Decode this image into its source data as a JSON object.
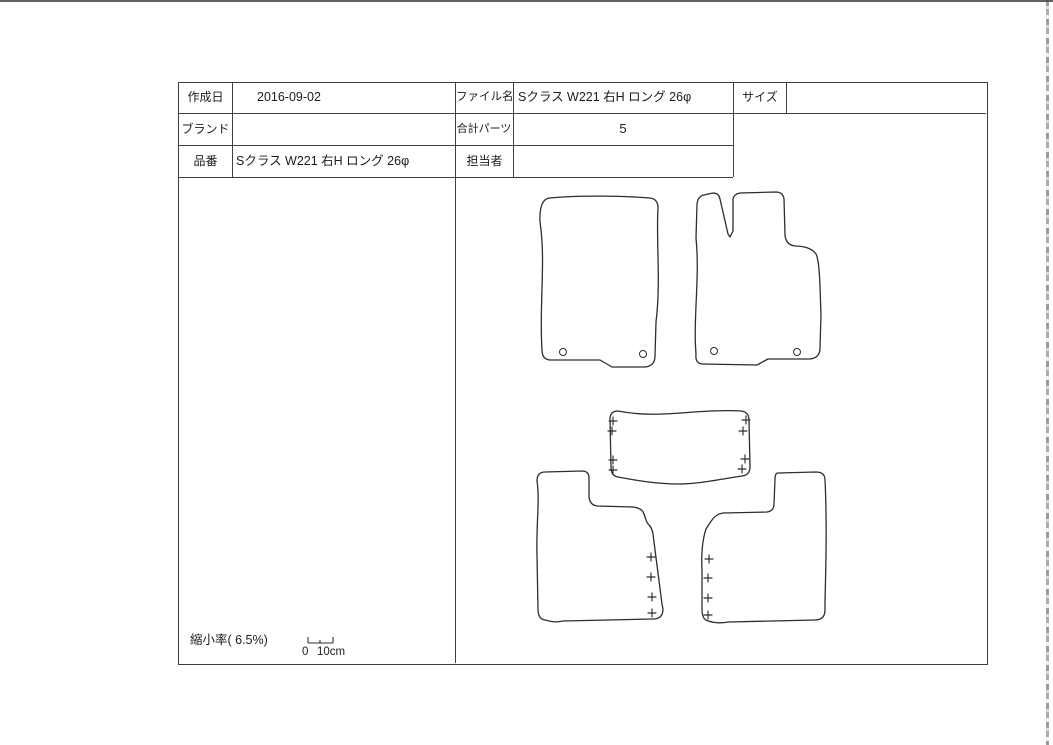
{
  "table": {
    "rows_left": [
      {
        "label": "作成日",
        "value": "2016-09-02"
      },
      {
        "label": "ブランド",
        "value": ""
      },
      {
        "label": "品番",
        "value": "Sクラス W221 右H ロング 26φ"
      }
    ],
    "rows_right": [
      {
        "label": "ファイル名",
        "value": "Sクラス W221 右H ロング 26φ"
      },
      {
        "label": "合計パーツ",
        "value": "5"
      },
      {
        "label": "担当者",
        "value": ""
      }
    ],
    "size": {
      "label": "サイズ",
      "value": ""
    }
  },
  "footer": {
    "reduction_label": "縮小率( 6.5%)",
    "scale_zero": "0",
    "scale_unit": "10cm"
  },
  "colors": {
    "line": "#2d2d2d",
    "border": "#414141",
    "background": "#ffffff"
  }
}
